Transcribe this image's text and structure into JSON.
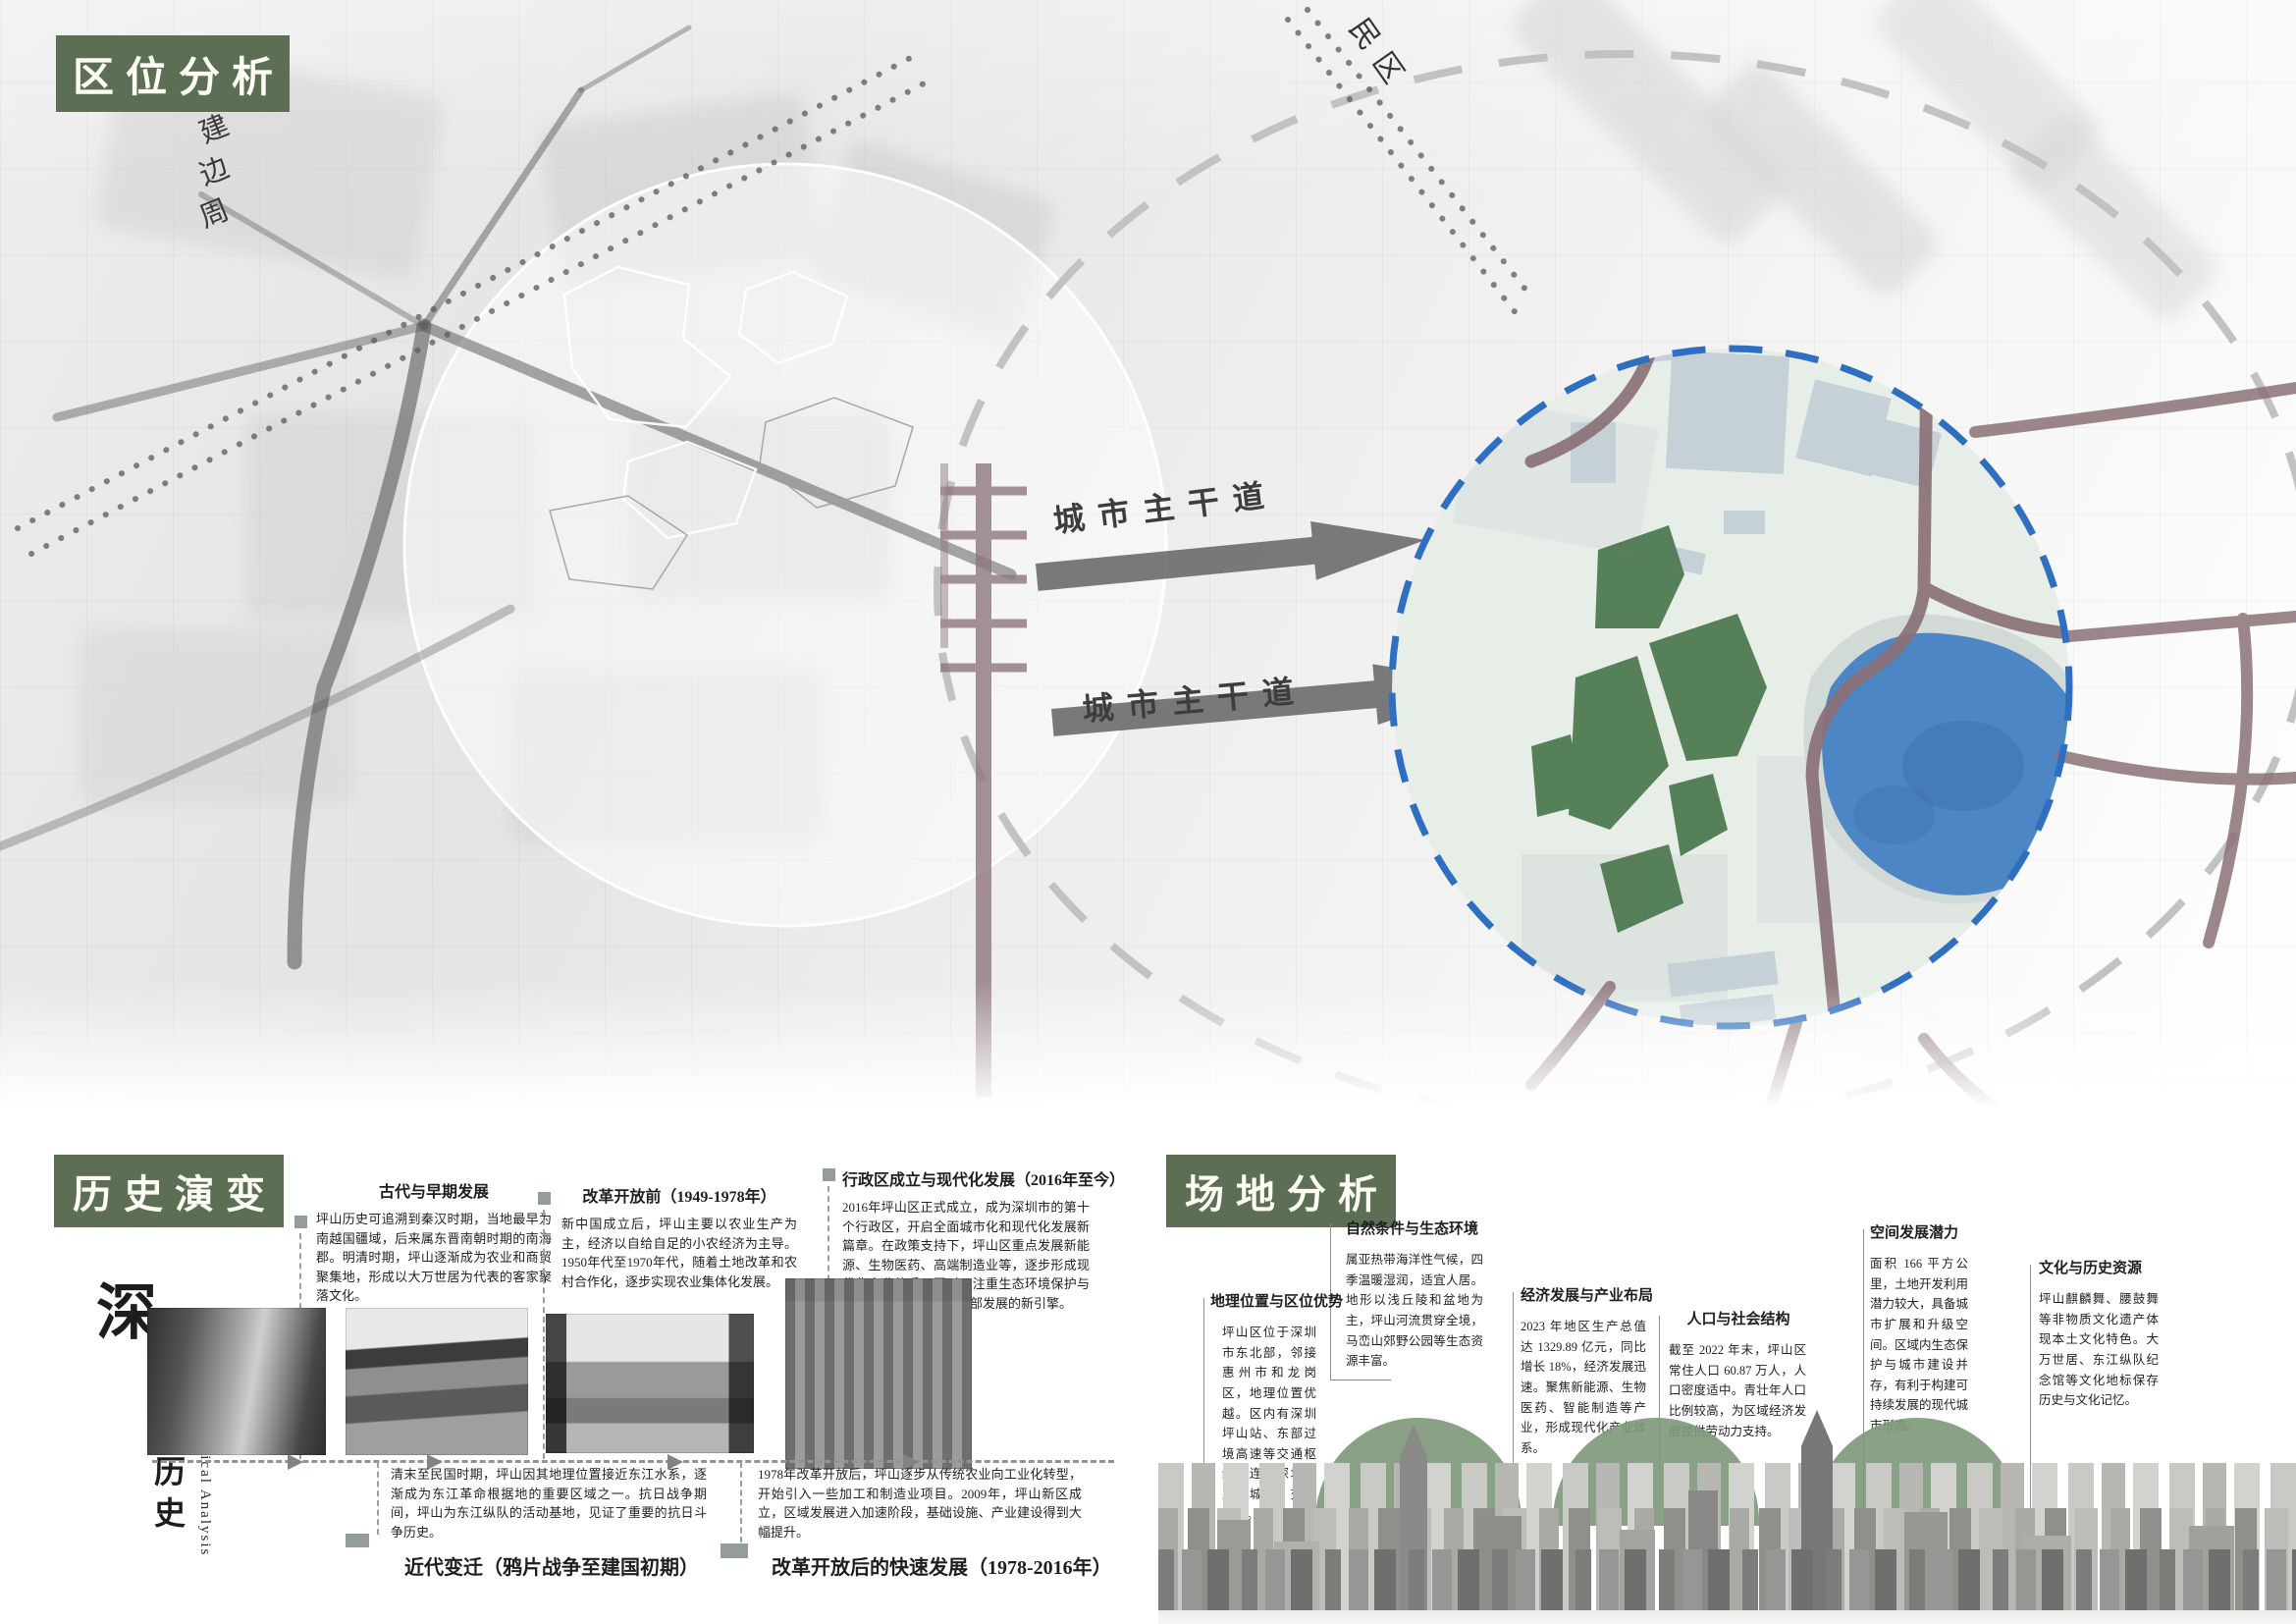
{
  "location": {
    "title": "区位分析",
    "road_label": "城市主干道",
    "residential_label": "民区",
    "peripheral_label_chars": [
      "建",
      "边",
      "周"
    ]
  },
  "history": {
    "title": "历史演变",
    "vertical_title_big": "深",
    "vertical_title_rest": "圳坪山历史",
    "vertical_subtitle": "Pingshan Historical Analysis",
    "periods": [
      {
        "title": "古代与早期发展",
        "text": "坪山历史可追溯到秦汉时期，当地最早为南越国疆域，后来属东晋南朝时期的南海郡。明清时期，坪山逐渐成为农业和商贸聚集地，形成以大万世居为代表的客家聚落文化。"
      },
      {
        "title": "改革开放前（1949-1978年）",
        "text": "新中国成立后，坪山主要以农业生产为主，经济以自给自足的小农经济为主导。1950年代至1970年代，随着土地改革和农村合作化，逐步实现农业集体化发展。"
      },
      {
        "title": "行政区成立与现代化发展（2016年至今）",
        "text": "2016年坪山区正式成立，成为深圳市的第十个行政区，开启全面城市化和现代化发展新篇章。在政策支持下，坪山区重点发展新能源、生物医药、高端制造业等，逐步形成现代化产业体系。同时，注重生态环境保护与文化传承，成为深圳东部发展的新引擎。"
      },
      {
        "title": "近代变迁（鸦片战争至建国初期）",
        "text": "清末至民国时期，坪山因其地理位置接近东江水系，逐渐成为东江革命根据地的重要区域之一。抗日战争期间，坪山为东江纵队的活动基地，见证了重要的抗日斗争历史。"
      },
      {
        "title": "改革开放后的快速发展（1978-2016年）",
        "text": "1978年改革开放后，坪山逐步从传统农业向工业化转型，开始引入一些加工和制造业项目。2009年，坪山新区成立，区域发展进入加速阶段，基础设施、产业建设得到大幅提升。"
      }
    ]
  },
  "site": {
    "title": "场地分析",
    "aspects": [
      {
        "title": "地理位置与区位优势",
        "text": "坪山区位于深圳市东北部，邻接惠州市和龙岗区，地理位置优越。区内有深圳坪山站、东部过境高速等交通枢纽，连接深圳与周边城市，交通便利。"
      },
      {
        "title": "自然条件与生态环境",
        "text": "属亚热带海洋性气候，四季温暖湿润，适宜人居。地形以浅丘陵和盆地为主，坪山河流贯穿全境，马峦山郊野公园等生态资源丰富。"
      },
      {
        "title": "经济发展与产业布局",
        "text": "2023 年地区生产总值达 1329.89 亿元，同比增长 18%，经济发展迅速。聚焦新能源、生物医药、智能制造等产业，形成现代化产业体系。"
      },
      {
        "title": "人口与社会结构",
        "text": "截至 2022 年末，坪山区常住人口 60.87 万人，人口密度适中。青壮年人口比例较高，为区域经济发展提供劳动力支持。"
      },
      {
        "title": "空间发展潜力",
        "text": "面积 166 平方公里，土地开发利用潜力较大，具备城市扩展和升级空间。区域内生态保护与城市建设并存，有利于构建可持续发展的现代城市形态。"
      },
      {
        "title": "文化与历史资源",
        "text": "坪山麒麟舞、腰鼓舞等非物质文化遗产体现本土文化特色。大万世居、东江纵队纪念馆等文化地标保存历史与文化记忆。"
      }
    ]
  },
  "colors": {
    "accent_green": "#5c6f54",
    "park_green": "#507b53",
    "lake_blue": "#4d86c5",
    "boundary_blue": "#2f6fc1",
    "road_mauve": "#8a7176"
  }
}
